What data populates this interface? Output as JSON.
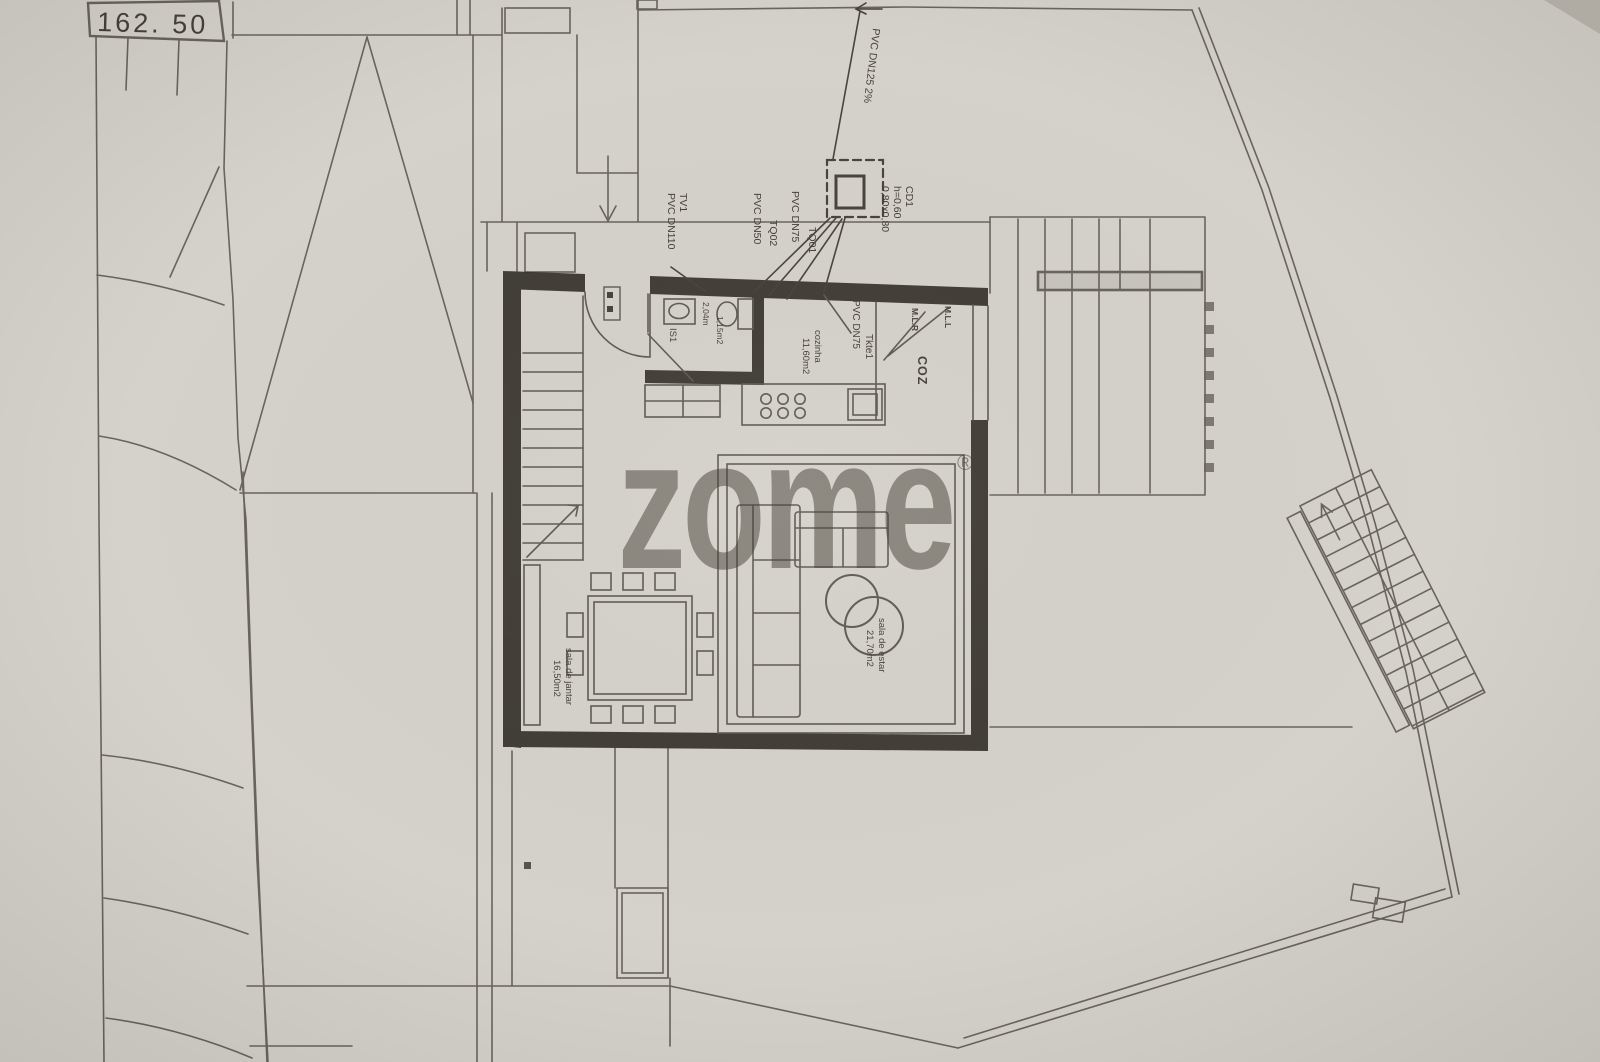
{
  "palette": {
    "paper": "#d5d2cb",
    "ink": "#5b564e",
    "wall": "#36322b",
    "text": "#474238"
  },
  "site": {
    "elevation_marker": "162. 50"
  },
  "plumbing": {
    "main_drain": {
      "pipe": "PVC DN125 2%"
    },
    "inspection_box": {
      "id": "CD1",
      "depth": "h=0,60",
      "size": "0,80x0,80"
    },
    "vent": {
      "id": "TV1",
      "pipe": "PVC DN110"
    },
    "stack_1": {
      "id": "TQ01",
      "pipe": "PVC DN75"
    },
    "stack_2": {
      "id": "TQ02",
      "pipe": "PVC DN50"
    },
    "kitchen_stack": {
      "id": "Tkte1",
      "pipe": "PVC DN75"
    }
  },
  "rooms": {
    "kitchen": {
      "tag": "COZ",
      "name": "cozinha",
      "area": "11,60m2"
    },
    "bathroom": {
      "tag": "IS1",
      "dim": "2,04m",
      "area": "1,15m2"
    },
    "dining": {
      "name": "sala de jantar",
      "area": "16,50m2"
    },
    "living": {
      "name": "sala de estar",
      "area": "21,70m2"
    }
  },
  "appliances": {
    "washing_machine": "M.L.R",
    "dishwasher": "M.L.L"
  },
  "watermark": {
    "logo": "zome",
    "registered": "®"
  }
}
